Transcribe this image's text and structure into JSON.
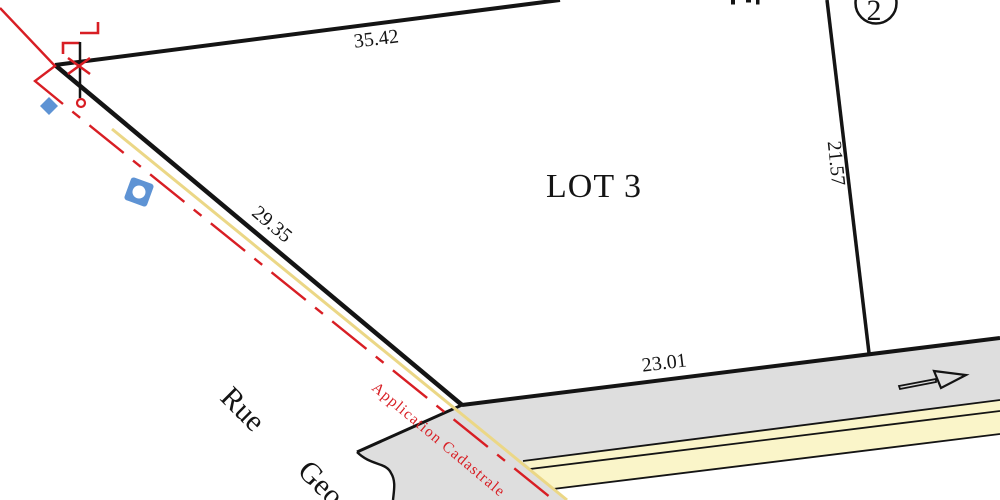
{
  "labels": {
    "lot": "LOT 3",
    "adjacent_parcel_number": "2",
    "street_word1": "Rue",
    "street_word2": "Geo",
    "cadastral_note": "Application Cadastrale"
  },
  "dimensions": {
    "top_edge": "35.42",
    "left_edge": "29.35",
    "right_edge": "21.57",
    "bottom_edge": "23.01"
  },
  "symbols": [
    "boundary-hook-marker-icon",
    "boundary-cross-marker-icon",
    "survey-point-circle-icon",
    "blue-diamond-symbol-icon",
    "blue-nut-symbol-icon",
    "road-direction-arrow-icon"
  ],
  "colors": {
    "boundary_black": "#141414",
    "cadastral_red": "#d81e24",
    "utility_yellow": "#ebd786",
    "road_gray": "#dedede",
    "sidewalk_cream": "#faf5c9",
    "symbol_blue": "#5e93d4"
  }
}
